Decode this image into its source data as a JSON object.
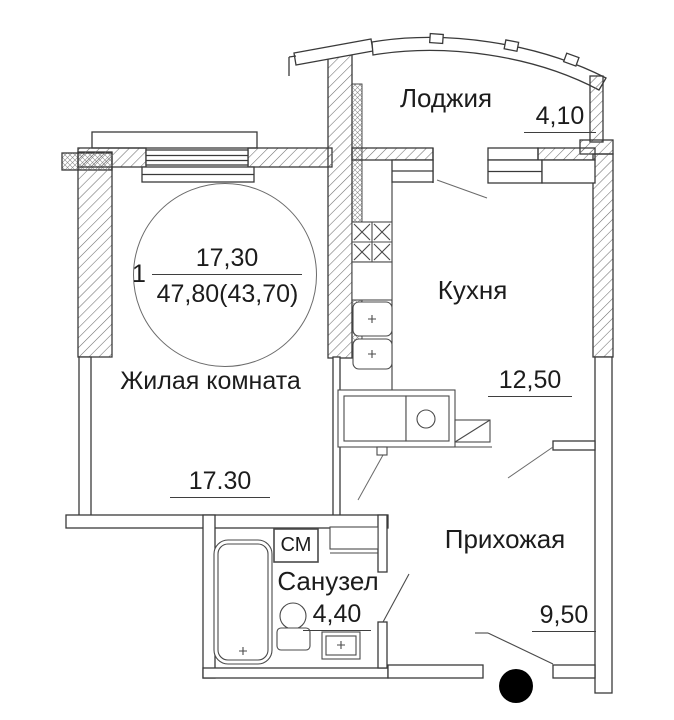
{
  "unit_circle": {
    "number": "1",
    "living_area": "17,30",
    "total_area": "47,80(43,70)"
  },
  "rooms": {
    "loggia": {
      "label": "Лоджия",
      "dimension": "4,10"
    },
    "kitchen": {
      "label": "Кухня",
      "dimension": "12,50"
    },
    "living_room": {
      "label": "Жилая комната",
      "dimension": "17.30"
    },
    "hallway": {
      "label": "Прихожая",
      "dimension": "9,50"
    },
    "bathroom": {
      "label": "Санузел",
      "dimension": "4,40"
    }
  },
  "appliances": {
    "washing_machine_label": "СМ"
  },
  "icons": [
    "stove-icon",
    "kitchen-cabinet-icon",
    "sink-icon",
    "dish-rack-icon",
    "bathtub-icon",
    "toilet-icon",
    "washbasin-icon",
    "washing-machine-icon",
    "entry-dot-icon",
    "door-swing-icon",
    "window-icon"
  ],
  "colors": {
    "wall_line": "#3a3a3a",
    "fixture_line": "#4a4a4a",
    "leader_line": "#6a6a6a",
    "text": "#1c1c1c",
    "entry_dot": "#000000",
    "background": "#ffffff"
  }
}
